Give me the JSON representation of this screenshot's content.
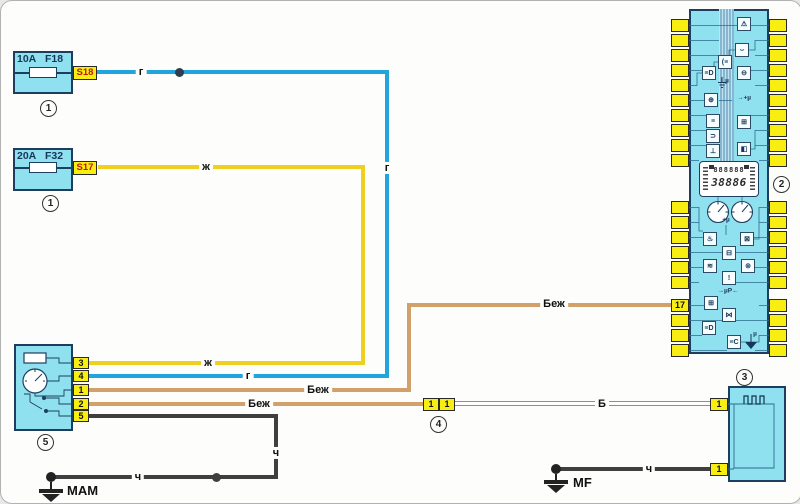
{
  "fuse_boxes": [
    {
      "amperage": "10A",
      "code": "F18",
      "tag": "S18",
      "badge": "1"
    },
    {
      "amperage": "20A",
      "code": "F32",
      "tag": "S17",
      "badge": "1"
    }
  ],
  "cluster": {
    "badge": "2",
    "pin_label": "17",
    "lcd_row1": "888888",
    "lcd_row2": "38886",
    "label_mu_plus": "→+µ",
    "label_mu_plus2": "+µ",
    "label_microprocessor": "→µP←",
    "label_mu": "µ",
    "icons": [
      {
        "x": 55,
        "y": 15,
        "glyph": "⚠",
        "name": "warning-lamp-icon"
      },
      {
        "x": 53,
        "y": 41,
        "glyph": "⌣",
        "name": "hood-open-icon"
      },
      {
        "x": 36,
        "y": 53,
        "glyph": "(≡",
        "name": "rear-fog-lamp-icon"
      },
      {
        "x": 20,
        "y": 64,
        "glyph": "≡D",
        "name": "high-beam-icon"
      },
      {
        "x": 55,
        "y": 64,
        "glyph": "⊖",
        "name": "side-lamp-icon"
      },
      {
        "x": 22,
        "y": 91,
        "glyph": "⊕",
        "name": "engine-check-icon"
      },
      {
        "x": 24,
        "y": 112,
        "glyph": "≡",
        "name": "battery-charge-icon"
      },
      {
        "x": 24,
        "y": 127,
        "glyph": "⊃",
        "name": "door-open-icon"
      },
      {
        "x": 24,
        "y": 142,
        "glyph": "⊥",
        "name": "handbrake-icon"
      },
      {
        "x": 55,
        "y": 113,
        "glyph": "⊞",
        "name": "abs-icon"
      },
      {
        "x": 55,
        "y": 140,
        "glyph": "◧",
        "name": "low-fuel-icon"
      },
      {
        "x": 21,
        "y": 230,
        "glyph": "♨",
        "name": "oil-pressure-icon"
      },
      {
        "x": 58,
        "y": 230,
        "glyph": "⊠",
        "name": "lamp-failure-icon"
      },
      {
        "x": 40,
        "y": 244,
        "glyph": "⊟",
        "name": "battery-icon"
      },
      {
        "x": 21,
        "y": 257,
        "glyph": "≋",
        "name": "coolant-temp-icon"
      },
      {
        "x": 59,
        "y": 257,
        "glyph": "⊚",
        "name": "brake-wear-icon"
      },
      {
        "x": 40,
        "y": 269,
        "glyph": "!",
        "name": "brake-warning-icon"
      },
      {
        "x": 22,
        "y": 294,
        "glyph": "⊞",
        "name": "heated-screen-icon"
      },
      {
        "x": 40,
        "y": 306,
        "glyph": "⋈",
        "name": "bulb-check-icon"
      },
      {
        "x": 20,
        "y": 319,
        "glyph": "≡D",
        "name": "low-beam-icon"
      },
      {
        "x": 45,
        "y": 333,
        "glyph": "≡C",
        "name": "dim-lamp-icon"
      }
    ]
  },
  "component3": {
    "badge": "3",
    "pin_top": "1",
    "pin_bottom": "1"
  },
  "connector4": {
    "badge": "4",
    "pins": [
      "1",
      "1"
    ]
  },
  "component5": {
    "badge": "5",
    "pins": [
      "3",
      "4",
      "1",
      "2",
      "5"
    ]
  },
  "grounds": [
    {
      "label": "МАМ"
    },
    {
      "label": "MF"
    }
  ],
  "wire_labels": [
    {
      "text": "г",
      "x": 140,
      "y": 71
    },
    {
      "text": "ж",
      "x": 205,
      "y": 166
    },
    {
      "text": "г",
      "x": 386,
      "y": 167
    },
    {
      "text": "ж",
      "x": 207,
      "y": 362
    },
    {
      "text": "г",
      "x": 247,
      "y": 375
    },
    {
      "text": "Беж",
      "x": 317,
      "y": 389
    },
    {
      "text": "Беж",
      "x": 258,
      "y": 403
    },
    {
      "text": "Беж",
      "x": 553,
      "y": 303
    },
    {
      "text": "Б",
      "x": 601,
      "y": 403
    },
    {
      "text": "ч",
      "x": 137,
      "y": 476
    },
    {
      "text": "ч",
      "x": 275,
      "y": 452
    },
    {
      "text": "ч",
      "x": 648,
      "y": 468
    }
  ],
  "colors": {
    "wire_blue": "#22a5dc",
    "wire_yellow": "#f0d01f",
    "wire_beige": "#d2a169",
    "wire_black": "#3f3f3f",
    "component_fill": "#8fe1ef",
    "pin_fill": "#f8ee12"
  }
}
